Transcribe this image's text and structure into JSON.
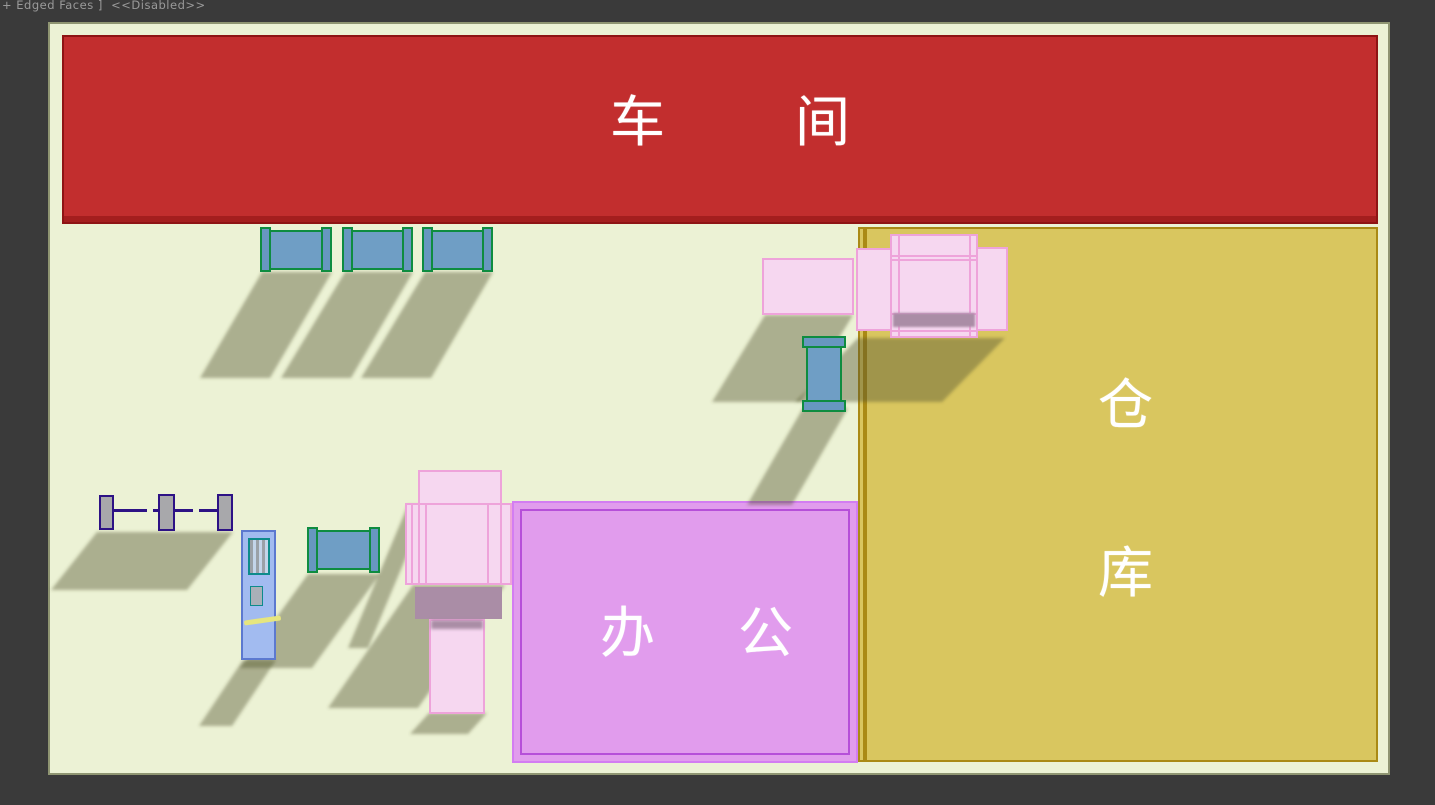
{
  "viewport": {
    "status_label": "+ Edged Faces ]  <<Disabled>>"
  },
  "zones": {
    "workshop": {
      "name": "车间",
      "label_chars": [
        "车",
        "间"
      ],
      "fill": "#c22e2e",
      "border": "#8e1414"
    },
    "warehouse": {
      "name": "仓库",
      "label_chars": [
        "仓",
        "库"
      ],
      "fill": "#d9c65f",
      "border": "#aa8a15"
    },
    "office": {
      "name": "办公",
      "label_chars": [
        "办",
        "公"
      ],
      "fill": "#e19ced",
      "border": "#b64fd9"
    }
  },
  "colors": {
    "viewport_background": "#3a3a3a",
    "floor": "#ecf2d5",
    "floor_border": "#8f9572",
    "machine_blue": "#6f9ec5",
    "machine_blue_border": "#0e8c40",
    "machine_pink": "#f6d7f0",
    "machine_pink_border": "#eea3da",
    "panel_light_blue": "#a2bbf0",
    "axle_purple": "#2d1285",
    "label_text": "#ffffff",
    "shadow": "rgba(80,84,45,0.42)"
  },
  "machines": {
    "top_rollers_count": 3,
    "items": [
      "roller-conveyor-1",
      "roller-conveyor-2",
      "roller-conveyor-3",
      "pink-slab-machine",
      "pink-cross-machine-right",
      "vertical-roller",
      "wheel-axle",
      "control-panel",
      "roller-conveyor-4",
      "pink-cross-machine-left"
    ]
  }
}
